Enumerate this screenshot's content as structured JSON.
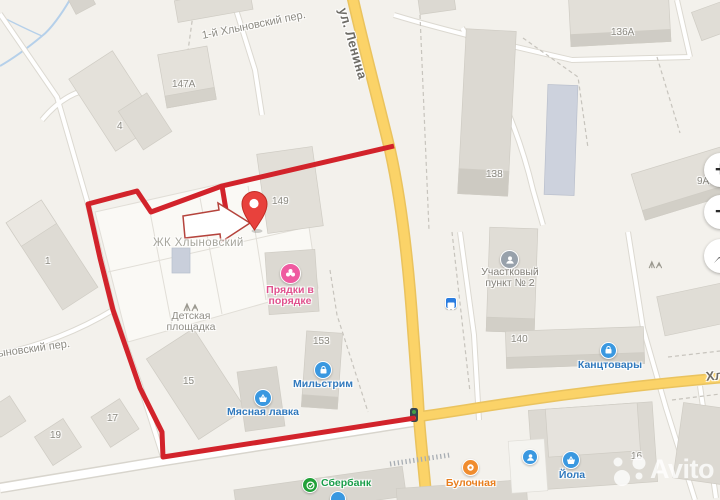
{
  "streets": {
    "lenina": "ул. Ленина",
    "per1": "1-й Хлыновский пер.",
    "per_left": "ыновский пер.",
    "right_clipped": "Хл"
  },
  "area": {
    "jk": "ЖК Хлыновский"
  },
  "buildings": {
    "b147a": "147А",
    "b4": "4",
    "b149": "149",
    "b138": "138",
    "b136a": "136А",
    "b1": "1",
    "b140": "140",
    "b153": "153",
    "b15": "15",
    "b19": "19",
    "b17": "17",
    "b16": "16",
    "b9a": "9А"
  },
  "pois": {
    "pryadki": {
      "line1": "Прядки в",
      "line2": "порядке"
    },
    "playground": {
      "line1": "Детская",
      "line2": "площадка"
    },
    "police": {
      "line1": "Участковый",
      "line2": "пункт № 2"
    },
    "kanctovary": {
      "label": "Канцтовары"
    },
    "milstrim": {
      "label": "Мильстрим"
    },
    "myasnaya": {
      "label": "Мясная лавка"
    },
    "sberbank": {
      "label": "Сбербанк"
    },
    "bulochnaya": {
      "label": "Булочная"
    },
    "yola": {
      "label": "Йола"
    }
  },
  "controls": {
    "zoom_in": "+",
    "zoom_out": "−"
  },
  "watermark": {
    "text": "Avito"
  },
  "colors": {
    "route_red": "#d2232b",
    "pin_red": "#e8413c",
    "road_yellow": "#fbd368",
    "poi_blue": "#3a98e0",
    "poi_pink": "#ef5aa0",
    "poi_orange": "#f08c2e",
    "poi_green": "#21a038",
    "poi_gray": "#98a1ab",
    "label_blue": "#3079bd",
    "label_pink": "#e0518d",
    "label_orange": "#e87e1e",
    "label_green": "#1a9e4a"
  }
}
